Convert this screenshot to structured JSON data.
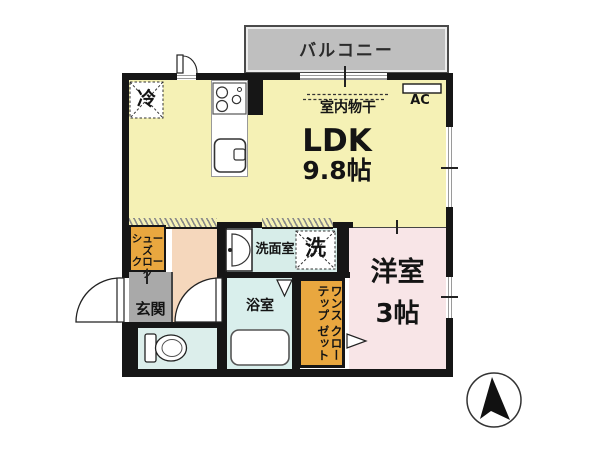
{
  "colors": {
    "wall": "#161616",
    "ldk": "#f5f1b5",
    "western": "#f8e5e7",
    "hall": "#f5d7bc",
    "closet": "#e9a73f",
    "entrance": "#a9a9a9",
    "washroom": "#d7ede9",
    "bath": "#d9efec",
    "toilet": "#dceeeb",
    "balcony": "#bfbfbf"
  },
  "balcony": {
    "label": "バルコニー"
  },
  "ldk": {
    "label": "LDK",
    "size": "9.8帖",
    "indoor_drying": "室内物干",
    "ac": "AC",
    "fridge": "冷"
  },
  "entrance": {
    "label": "玄関"
  },
  "shoe_closet": {
    "line1": "シューズ",
    "line2": "クローク"
  },
  "washroom": {
    "label": "洗面室",
    "washer": "洗"
  },
  "bathroom": {
    "label": "浴室"
  },
  "western_room": {
    "label": "洋室",
    "size": "3帖"
  },
  "step_closet": {
    "col1": "ワンステップ",
    "col2": "クローゼット"
  }
}
